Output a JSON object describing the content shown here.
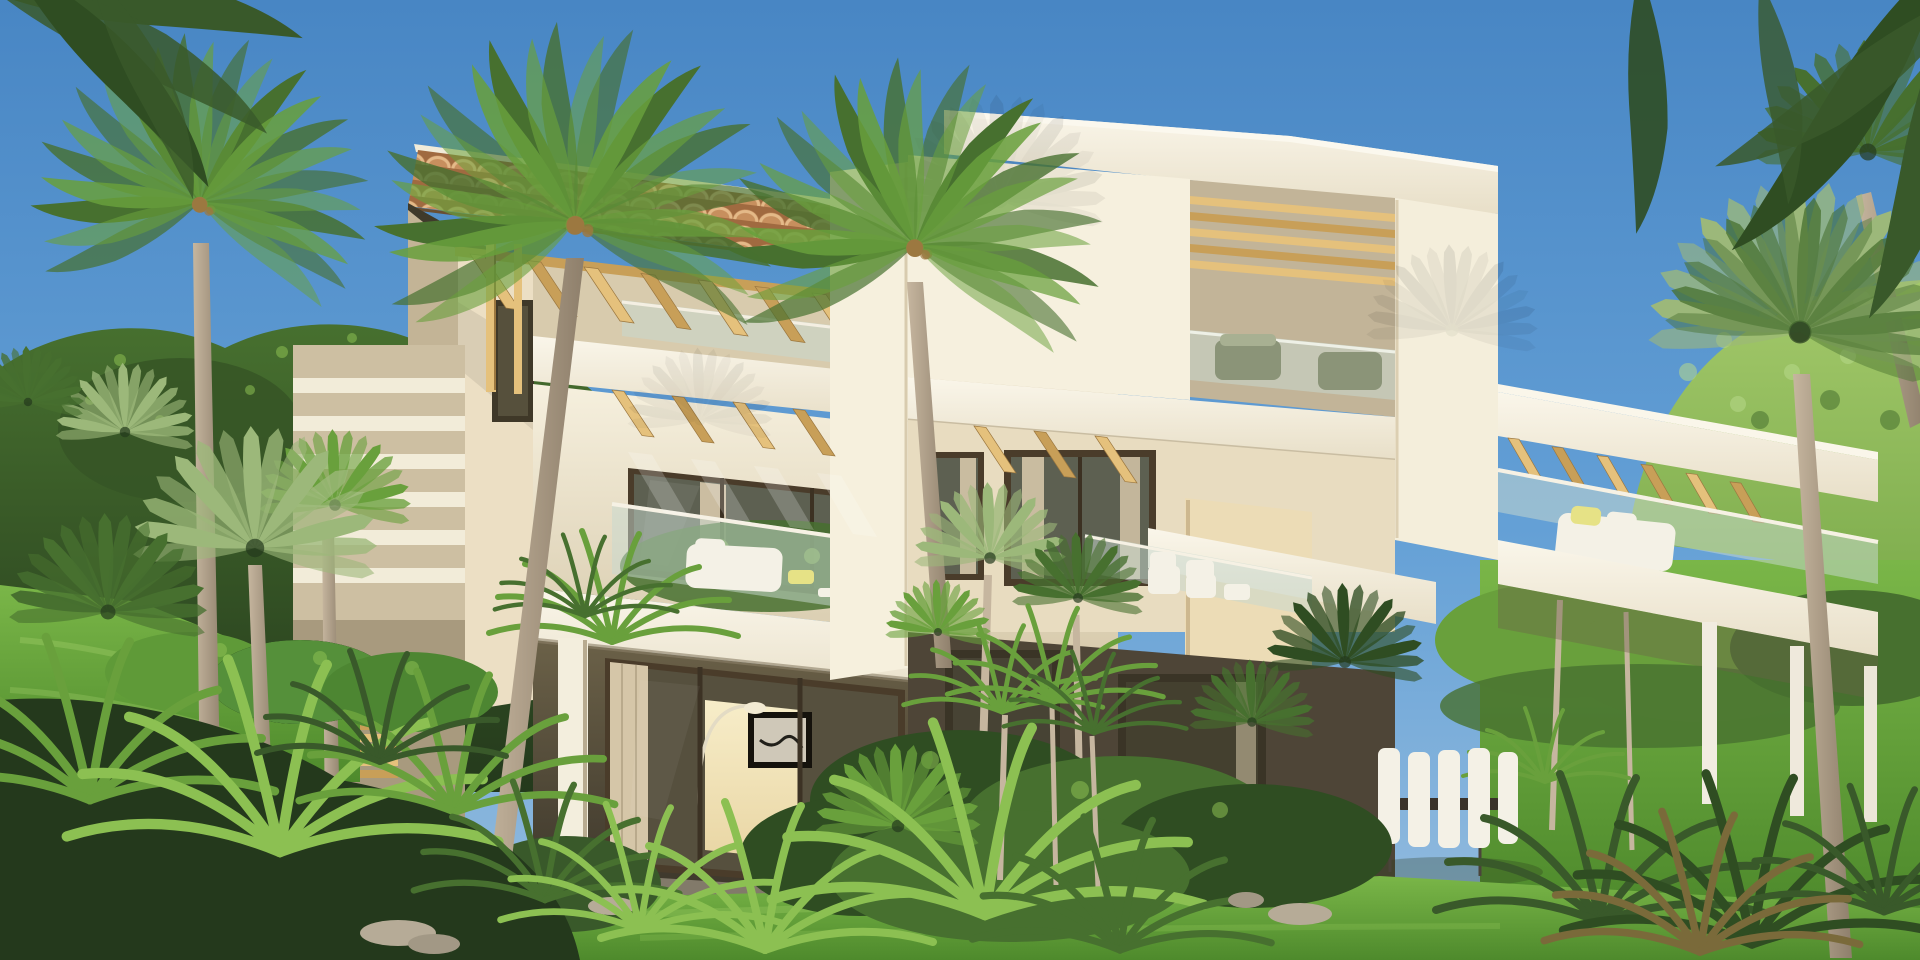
{
  "meta": {
    "title": "Modern tropical villa exterior – 3D architectural render",
    "scene_type": "photoreal exterior rendering, no text or UI elements visible"
  },
  "palette": {
    "sky_top": "#4886c4",
    "sky_mid": "#64a0d6",
    "sky_low": "#97bedf",
    "wall_light": "#f6f0de",
    "wall_cream": "#ecdfc4",
    "wall_mid": "#d8cbad",
    "wall_shadow": "#c3b496",
    "soffit_dark": "#3f3a2b",
    "recess_top": "#6b6148",
    "recess_bot": "#3b352a",
    "roof_tile": "#c78f5e",
    "roof_tile_light": "#e4b988",
    "roof_tile_dark": "#a06a40",
    "roof_edge": "#6a4f33",
    "wood_light": "#e5c17c",
    "wood_mid": "#c89f58",
    "wood_dark": "#9c7840",
    "glass_tint": "#c7d8cf",
    "frame_dark": "#4a3c2a",
    "pane_mid": "#5d6051",
    "pane_dark": "#56503e",
    "curtain": "#d5c6a8",
    "interior_warm": "#e9d6a4",
    "interior_glow": "#f7edc9",
    "green_dark": "#24391c",
    "green_deep": "#2f4d22",
    "green_mid": "#47702f",
    "green_bright": "#69a03c",
    "green_light": "#8cc052",
    "green_pale": "#b7d98a",
    "palm_silver": "#9cb87a",
    "palm_deep": "#39592a",
    "trunk_light": "#c6b69f",
    "trunk_dark": "#8e7f6b",
    "lawn_top": "#7ab648",
    "lawn_bot": "#4e8a2c",
    "hill_light": "#a4c96b",
    "hill_mid": "#7fae4e",
    "furniture_white": "#f4f1e6",
    "cushion_yellow": "#e6e286",
    "seat_grey": "#8b9478",
    "rock_grey": "#b6ab97",
    "floor_grey": "#8a8271",
    "slab_top": "#faf6ea",
    "slab_bot": "#e8dfc8"
  },
  "scene": {
    "sky": "clear blue gradient sky",
    "background": [
      "sunlit green hill on the right",
      "dense leafy tree mass behind the left garden"
    ],
    "building": {
      "left_tower": [
        "terracotta barrel-tile roof",
        "golden wood pergola beams at the eave",
        "dark shaded soffit",
        "upper-floor glass balustrade",
        "white fascia slab",
        "second pergola over middle balcony",
        "glass balcony with white sofa and yellow cushion",
        "recessed ground floor with sliding glass doors, warm lit interior, abstract art and arc lamp",
        "white support column"
      ],
      "right_block": [
        "flat white roof volume",
        "recessed rooftop terrace with wood beams and glass rail",
        "grey-green outdoor seats",
        "beige middle facade with framed windows and curtains",
        "balcony with white chairs",
        "dark ground-floor glazing"
      ],
      "right_wing": [
        "long cantilevered roof slab with pergola",
        "glass balustrade terrace with white sofa",
        "slender white columns",
        "white outdoor dining chairs and dark table"
      ]
    },
    "vegetation": [
      "tall fan palms with pale trunks",
      "silvery fan-palm clusters",
      "tropical ferns and cycads",
      "clipped hedge on grassy bank",
      "bright lawn foreground",
      "palm fronds hanging into the top corners",
      "grey garden rocks"
    ]
  }
}
